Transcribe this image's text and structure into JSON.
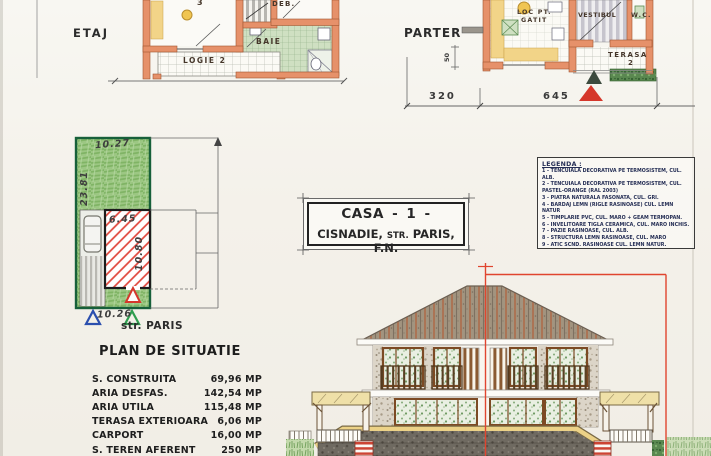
{
  "plans": {
    "etaj": {
      "label": "ETAJ",
      "room3": "3",
      "deb": "DEB.",
      "baie": "BAIE",
      "logie": "LOGIE 2"
    },
    "parter": {
      "label": "PARTER",
      "loc_pt": "LOC PT.",
      "gatit": "GATIT",
      "vestibul": "VESTIBUL",
      "wc": "W.C.",
      "terasa": "TERASA",
      "terasa_no": "2",
      "dim_320": "320",
      "dim_645": "645",
      "dim_50": "50"
    }
  },
  "site_plan": {
    "street": "str. PARIS",
    "dim_top": "10.27",
    "dim_left": "23.81",
    "dim_bottom": "10.26",
    "dim_building_width": "6.45",
    "dim_building_depth": "10.80"
  },
  "title_block": {
    "line1": "CASA  - 1 -",
    "city": "CISNADIE,",
    "street_abbr": "STR.",
    "street": "PARIS, F.N."
  },
  "legend": {
    "title": "LEGENDA :",
    "items": [
      "1 - TENCUIALA DECORATIVA PE TERMOSISTEM, CUL. ALB.",
      "2 - TENCUIALA DECORATIVA PE TERMOSISTEM, CUL. PASTEL-ORANGE (RAL 2003)",
      "3 - PIATRA NATURALA FASONATA, CUL. GRI.",
      "4 - BARDAJ LEMN (RIGLE RASINOASE) CUL. LEMN NATUR",
      "5 - TIMPLARIE PVC, CUL. MARO + GEAM TERMOPAN.",
      "6 - INVELITOARE TIGLA CERAMICA, CUL. MARO INCHIS.",
      "7 - PAZIE RASINOASE, CUL. ALB.",
      "8 - STRUCTURA LEMN RASINOASE, CUL. MARO",
      "9 - ATIC SCND. RASINOASE CUL. LEMN NATUR.",
      "10 - BALUSTRADA (PARAPET) CONF. METALICE CUL. NEGRU",
      "11 - INVELITOARE TABLA CUTATA CUL. MARO"
    ]
  },
  "situation_table": {
    "title": "PLAN DE SITUATIE",
    "rows": [
      {
        "label": "S. CONSTRUITA",
        "value": "69,96 MP"
      },
      {
        "label": "ARIA DESFAS.",
        "value": "142,54 MP"
      },
      {
        "label": "ARIA UTILA",
        "value": "115,48 MP"
      },
      {
        "label": "TERASA EXTERIOARA",
        "value": "6,06 MP"
      },
      {
        "label": "CARPORT",
        "value": "16,00 MP"
      },
      {
        "label": "S. TEREN AFERENT",
        "value": "250 MP"
      }
    ]
  },
  "colors": {
    "accent_red": "#d5372b",
    "boundary_red": "#e0452f",
    "parcel_green": "#94c47e",
    "wall_orange": "#e0885c",
    "legend_ink": "#252e55",
    "marker_blue": "#2b4fae",
    "marker_green": "#2f9e4f",
    "counter_yellow": "#f2d488"
  }
}
